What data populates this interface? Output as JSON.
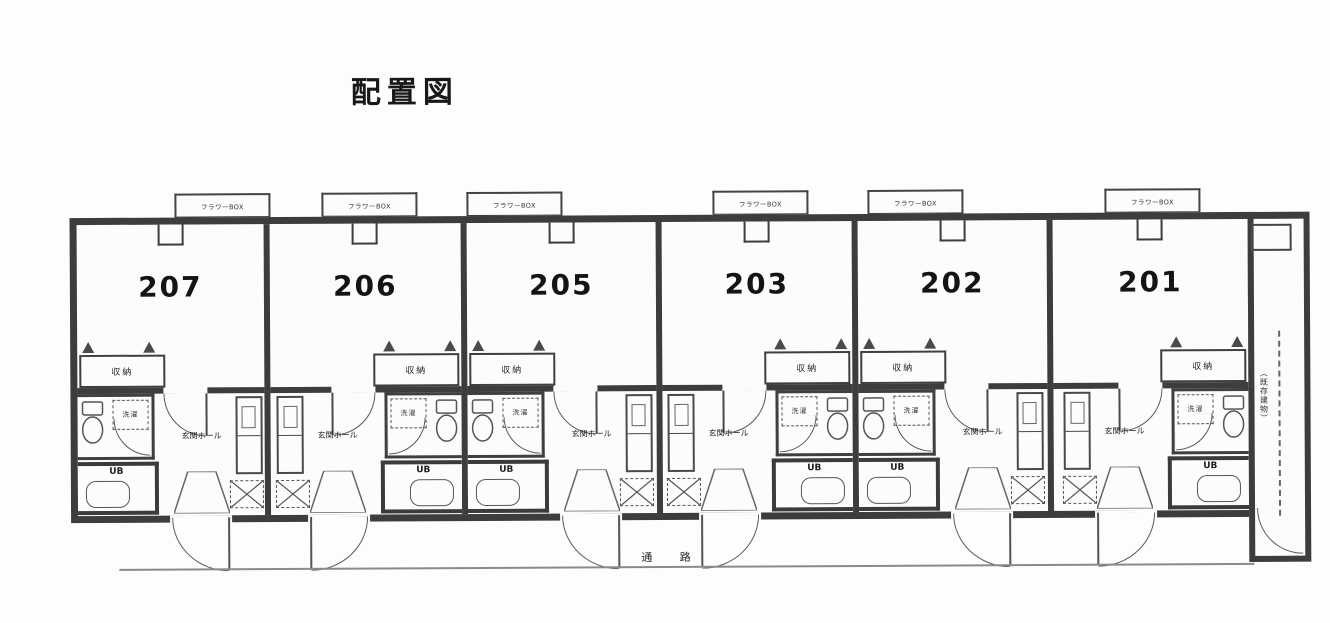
{
  "title": "配置図",
  "drawing": {
    "walkway_label": "通 路",
    "flower_box_label": "フラワーBOX",
    "annex_note": "（既存建物）"
  },
  "unit_labels": {
    "closet": "収納",
    "laundry": "洗濯",
    "unit_bath": "UB",
    "entrance_hall": "玄関ホール"
  },
  "units": [
    {
      "number": "207",
      "mirrored": false,
      "left": 0,
      "width": 193
    },
    {
      "number": "206",
      "mirrored": true,
      "left": 193,
      "width": 197
    },
    {
      "number": "205",
      "mirrored": false,
      "left": 390,
      "width": 195
    },
    {
      "number": "203",
      "mirrored": true,
      "left": 585,
      "width": 196
    },
    {
      "number": "202",
      "mirrored": false,
      "left": 781,
      "width": 195
    },
    {
      "number": "201",
      "mirrored": true,
      "left": 976,
      "width": 195
    }
  ],
  "flower_boxes": [
    {
      "left": 175
    },
    {
      "left": 322
    },
    {
      "left": 467
    },
    {
      "left": 713
    },
    {
      "left": 868
    },
    {
      "left": 1105
    }
  ],
  "colors": {
    "paper": "#fcfcfc",
    "wall": "#3d3d3d",
    "line": "#555555",
    "text": "#1f1f1f"
  }
}
